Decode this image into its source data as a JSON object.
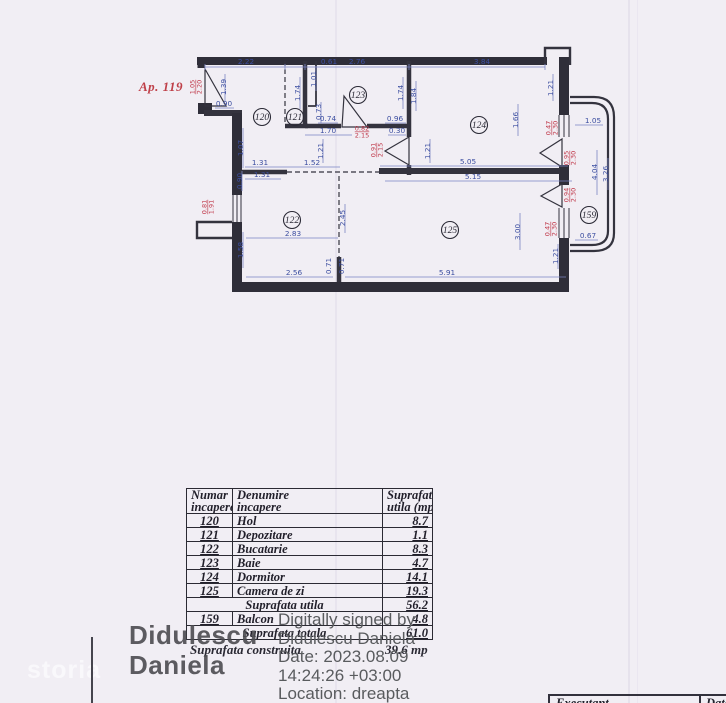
{
  "apartment": {
    "label": "Ap. 119"
  },
  "plan": {
    "rooms": [
      {
        "num": "120",
        "x": 262,
        "y": 117
      },
      {
        "num": "121",
        "x": 295,
        "y": 117
      },
      {
        "num": "123",
        "x": 358,
        "y": 95
      },
      {
        "num": "124",
        "x": 479,
        "y": 125
      },
      {
        "num": "122",
        "x": 292,
        "y": 220
      },
      {
        "num": "125",
        "x": 450,
        "y": 230
      },
      {
        "num": "159",
        "x": 589,
        "y": 215
      }
    ],
    "dims": [
      {
        "t": "2.22",
        "x": 246,
        "y": 64
      },
      {
        "t": "0.61",
        "x": 329,
        "y": 64
      },
      {
        "t": "2.76",
        "x": 357,
        "y": 64
      },
      {
        "t": "3.84",
        "x": 482,
        "y": 64
      },
      {
        "t": "1.39",
        "x": 226,
        "y": 87,
        "r": -90
      },
      {
        "t": "0.90",
        "x": 224,
        "y": 106
      },
      {
        "t": "1.74",
        "x": 300,
        "y": 93,
        "r": -90
      },
      {
        "t": "1.01",
        "x": 316,
        "y": 79,
        "r": -90
      },
      {
        "t": "0.73",
        "x": 321,
        "y": 112,
        "r": -90
      },
      {
        "t": "0.74",
        "x": 328,
        "y": 121
      },
      {
        "t": "1.74",
        "x": 403,
        "y": 93,
        "r": -90
      },
      {
        "t": "1.84",
        "x": 416,
        "y": 96,
        "r": -90
      },
      {
        "t": "0.96",
        "x": 395,
        "y": 121
      },
      {
        "t": "0.30",
        "x": 397,
        "y": 133
      },
      {
        "t": "1.70",
        "x": 328,
        "y": 133
      },
      {
        "t": "1.21",
        "x": 323,
        "y": 151,
        "r": -90
      },
      {
        "t": "1.21",
        "x": 430,
        "y": 151,
        "r": -90
      },
      {
        "t": "1.07",
        "x": 243,
        "y": 148,
        "r": -90
      },
      {
        "t": "1.31",
        "x": 260,
        "y": 165
      },
      {
        "t": "1.52",
        "x": 312,
        "y": 165
      },
      {
        "t": "1.31",
        "x": 262,
        "y": 177
      },
      {
        "t": "0.90",
        "x": 242,
        "y": 181,
        "r": -90
      },
      {
        "t": "1.66",
        "x": 518,
        "y": 120,
        "r": -90
      },
      {
        "t": "1.21",
        "x": 553,
        "y": 88,
        "r": -90
      },
      {
        "t": "5.05",
        "x": 468,
        "y": 164
      },
      {
        "t": "5.15",
        "x": 473,
        "y": 179
      },
      {
        "t": "3.00",
        "x": 520,
        "y": 232,
        "r": -90
      },
      {
        "t": "5.91",
        "x": 447,
        "y": 275
      },
      {
        "t": "2.83",
        "x": 293,
        "y": 236
      },
      {
        "t": "1.58",
        "x": 243,
        "y": 250,
        "r": -90
      },
      {
        "t": "2.56",
        "x": 294,
        "y": 275
      },
      {
        "t": "0.71",
        "x": 331,
        "y": 266,
        "r": -90
      },
      {
        "t": "0.71",
        "x": 344,
        "y": 266,
        "r": -90
      },
      {
        "t": "2.45",
        "x": 345,
        "y": 218,
        "r": -90
      },
      {
        "t": "1.05",
        "x": 593,
        "y": 123
      },
      {
        "t": "4.04",
        "x": 597,
        "y": 172,
        "r": -90
      },
      {
        "t": "3.26",
        "x": 608,
        "y": 174,
        "r": -90
      },
      {
        "t": "0.67",
        "x": 588,
        "y": 238
      },
      {
        "t": "1.21",
        "x": 558,
        "y": 256,
        "r": -90
      },
      {
        "t": "1.05",
        "t2": "2.20",
        "x": 196,
        "y": 87,
        "r": -90,
        "red": true
      },
      {
        "t": "0.82",
        "t2": "2.15",
        "x": 362,
        "y": 132,
        "red": true
      },
      {
        "t": "0.91",
        "t2": "2.15",
        "x": 377,
        "y": 150,
        "r": -90,
        "red": true
      },
      {
        "t": "0.81",
        "t2": "1.91",
        "x": 208,
        "y": 207,
        "r": -90,
        "red": true
      },
      {
        "t": "0.47",
        "t2": "2.30",
        "x": 552,
        "y": 128,
        "r": -90,
        "red": true
      },
      {
        "t": "0.95",
        "t2": "2.30",
        "x": 570,
        "y": 158,
        "r": -90,
        "red": true
      },
      {
        "t": "0.94",
        "t2": "2.30",
        "x": 570,
        "y": 195,
        "r": -90,
        "red": true
      },
      {
        "t": "0.47",
        "t2": "2.30",
        "x": 551,
        "y": 229,
        "r": -90,
        "red": true
      }
    ]
  },
  "table": {
    "headers": [
      [
        "Numar",
        "incapere"
      ],
      [
        "Denumire",
        "incapere"
      ],
      [
        "Suprafata",
        "utila (mp)"
      ]
    ],
    "rows": [
      {
        "num": "120",
        "name": "Hol",
        "val": "8.7"
      },
      {
        "num": "121",
        "name": "Depozitare",
        "val": "1.1"
      },
      {
        "num": "122",
        "name": "Bucatarie",
        "val": "8.3"
      },
      {
        "num": "123",
        "name": "Baie",
        "val": "4.7"
      },
      {
        "num": "124",
        "name": "Dormitor",
        "val": "14.1"
      },
      {
        "num": "125",
        "name": "Camera de zi",
        "val": "19.3"
      },
      {
        "span": true,
        "name": "Suprafata utila",
        "val": "56.2"
      },
      {
        "num": "159",
        "name": "Balcon",
        "val": "4.8"
      },
      {
        "span": true,
        "name": "Suprafata totala",
        "val": "61.0"
      }
    ],
    "construita_label": "Suprafata construita",
    "construita_value": "39.6 mp"
  },
  "signature": {
    "name_line1": "Didulescu",
    "name_line2": "Daniela",
    "details": [
      "Digitally signed by",
      "Didulescu Daniela",
      "Date: 2023.08.09",
      "14:24:26 +03:00",
      "Location: dreapta"
    ]
  },
  "watermark": "storia",
  "footer": {
    "executant": "Executant",
    "data": "Data"
  }
}
